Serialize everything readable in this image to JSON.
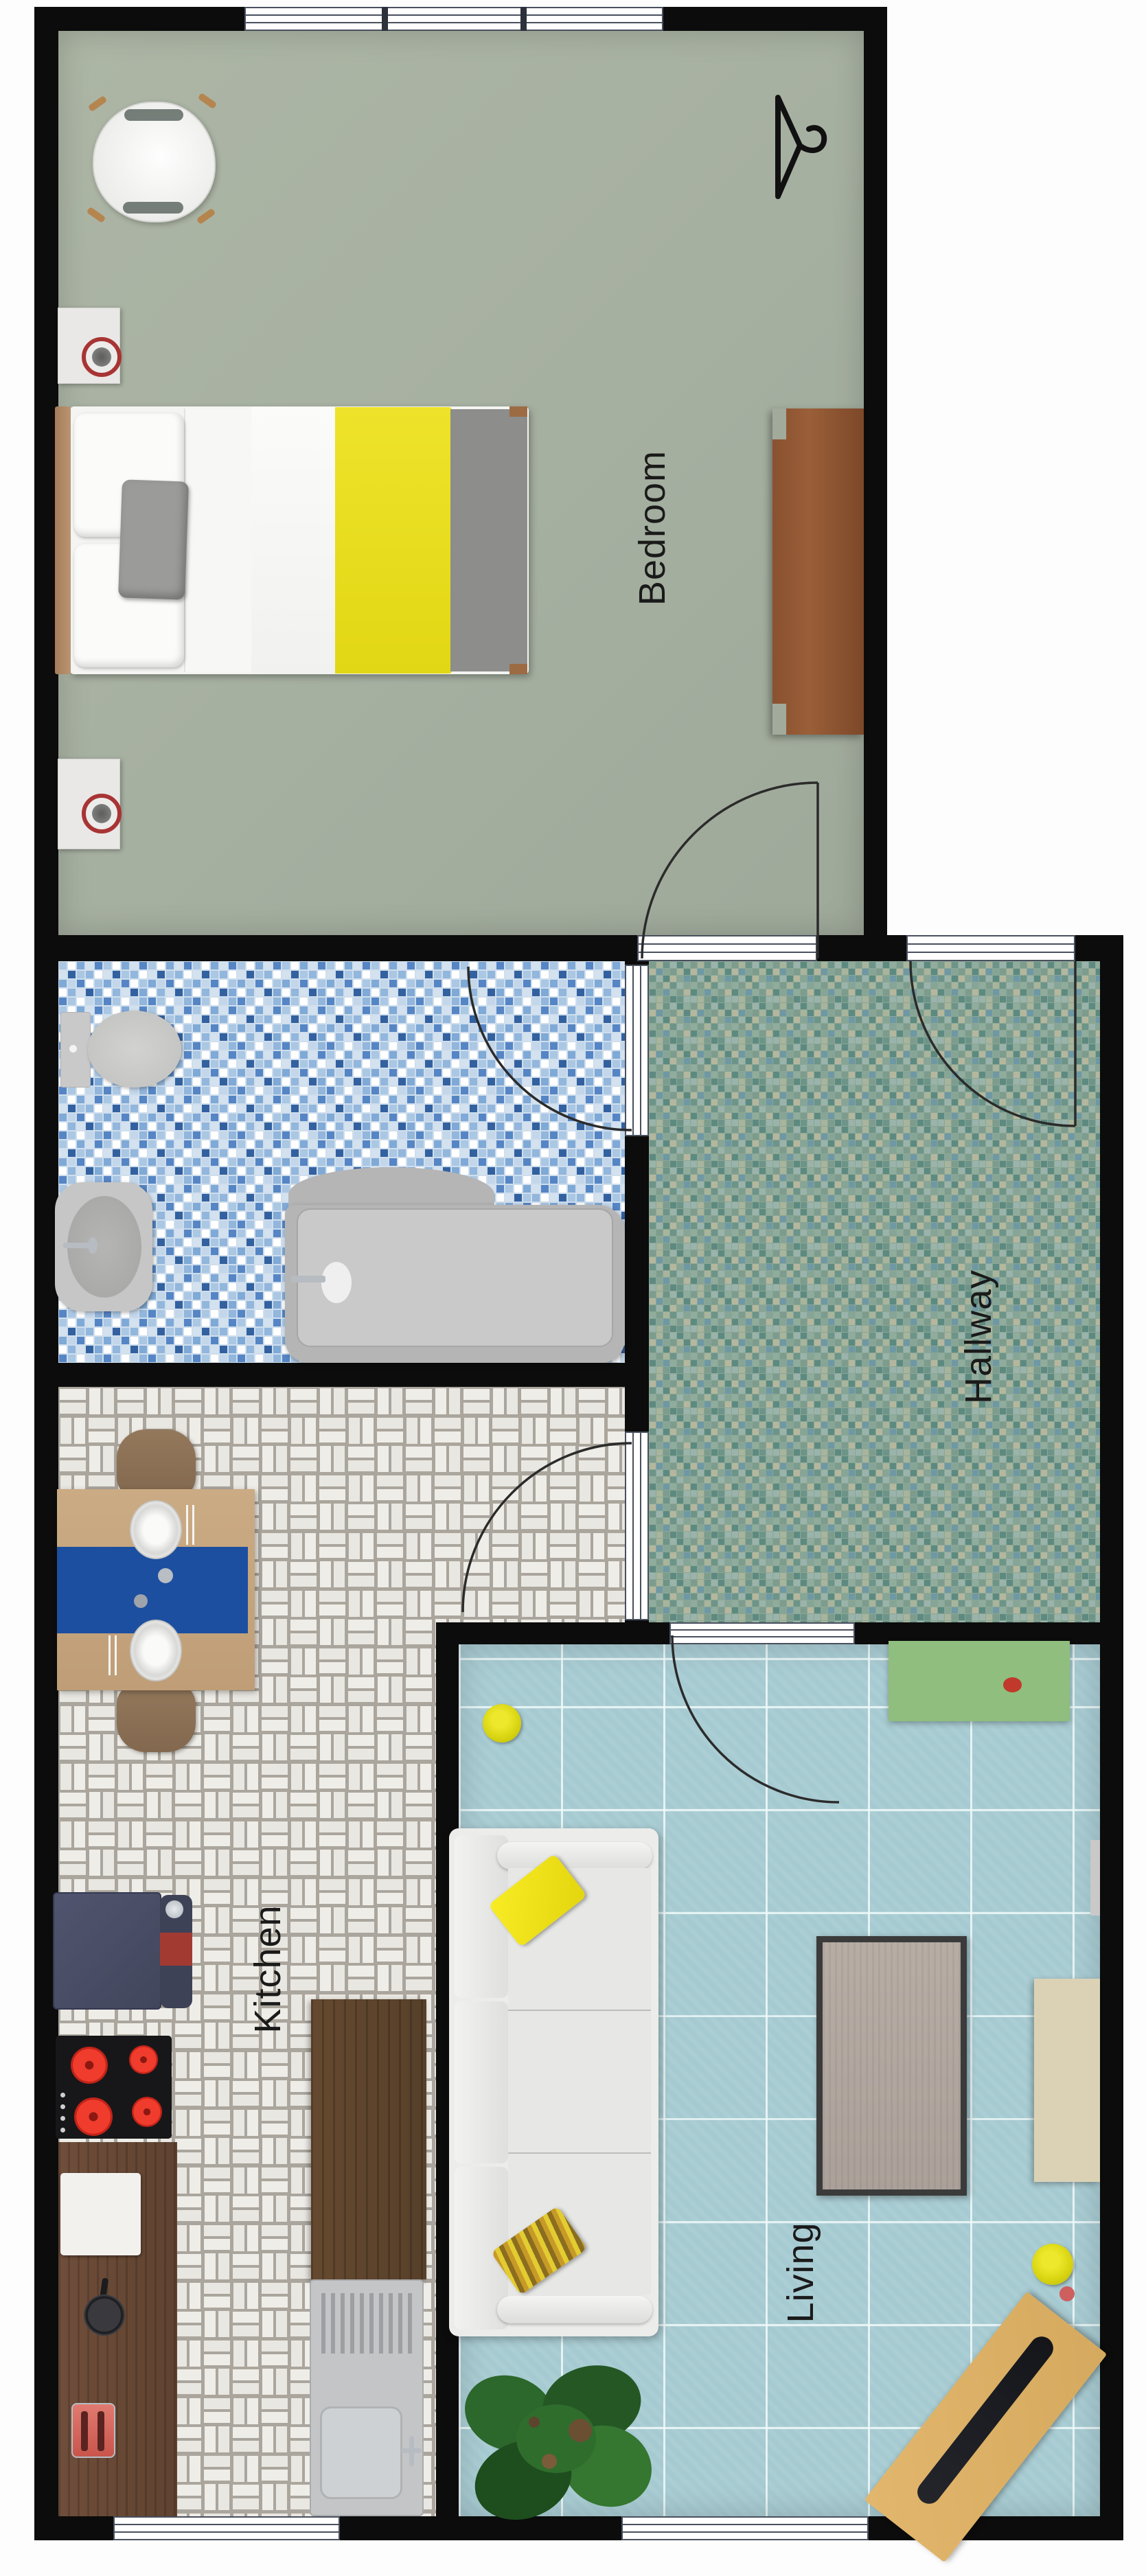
{
  "plan": {
    "type": "apartment floor plan, top-down render",
    "orientation": "room labels rotated 90° CCW (read bottom-to-top)"
  },
  "rooms": {
    "bedroom": {
      "label": "Bedroom",
      "floor": "sage green",
      "floor_color": "#a9b2a1"
    },
    "bathroom": {
      "label": "",
      "floor": "blue mosaic tile",
      "floor_color": "#9fc0e0"
    },
    "hallway": {
      "label": "Hallway",
      "floor": "green-teal mosaic",
      "floor_color": "#8ba695"
    },
    "kitchen": {
      "label": "Kitchen",
      "floor": "white basketweave tile",
      "floor_color": "#efede8"
    },
    "living": {
      "label": "Living",
      "floor": "light blue tile grid",
      "floor_color": "#a6cad1"
    }
  },
  "furniture": {
    "bedroom": [
      "double-bed",
      "headboard",
      "white-pillows",
      "gray-pillow",
      "yellow-duvet",
      "gray-blanket",
      "nightstand-2x",
      "red-ring-speaker-2x",
      "white-shell-armchair",
      "wood-sideboard",
      "hanger-icon"
    ],
    "bathroom": [
      "toilet",
      "bidet-sink",
      "bathtub"
    ],
    "kitchen": [
      "dining-table",
      "blue-table-runner",
      "plate-2x",
      "dining-chair-2x",
      "fridge",
      "stand-mixer",
      "induction-cooktop-4-burners",
      "wood-counter",
      "cutting-board",
      "pan",
      "red-toaster",
      "island-counter",
      "sink-with-drainer"
    ],
    "living": [
      "white-3-seat-sofa",
      "yellow-pillow",
      "zigzag-pillow",
      "yellow-pouf-2x",
      "green-wall-shelf",
      "coffee-table",
      "beige-sideboard",
      "wood-bench",
      "black-soundbar",
      "potted-plant"
    ]
  },
  "palette": {
    "walls": "#0c0c0c",
    "bedroom_floor": "#a9b2a1",
    "bathroom_tile_blues": [
      "#ffffff",
      "#d4e2f0",
      "#aac7e3",
      "#7fa9d6",
      "#5585c4",
      "#33619f"
    ],
    "hallway_tile_greens": [
      "#7d9c8d",
      "#8fac9d",
      "#6d9488",
      "#a8b49c",
      "#5d8a80",
      "#6f98a5"
    ],
    "kitchen_tile": "#efede8",
    "living_tile": "#a6cad1",
    "accent_yellow": "#e8df21",
    "runner_blue": "#1c4fa0",
    "burner_red": "#ef3c2d",
    "speaker_ring_red": "#a83434",
    "shelf_green": "#8fbe7e",
    "bench_tan": "#d9ae63"
  },
  "doors": [
    "bedroom-door",
    "entry-door",
    "bathroom-door",
    "kitchen-door",
    "living-door"
  ],
  "windows": [
    "bedroom-top-window",
    "kitchen-bottom-window",
    "living-bottom-window"
  ]
}
